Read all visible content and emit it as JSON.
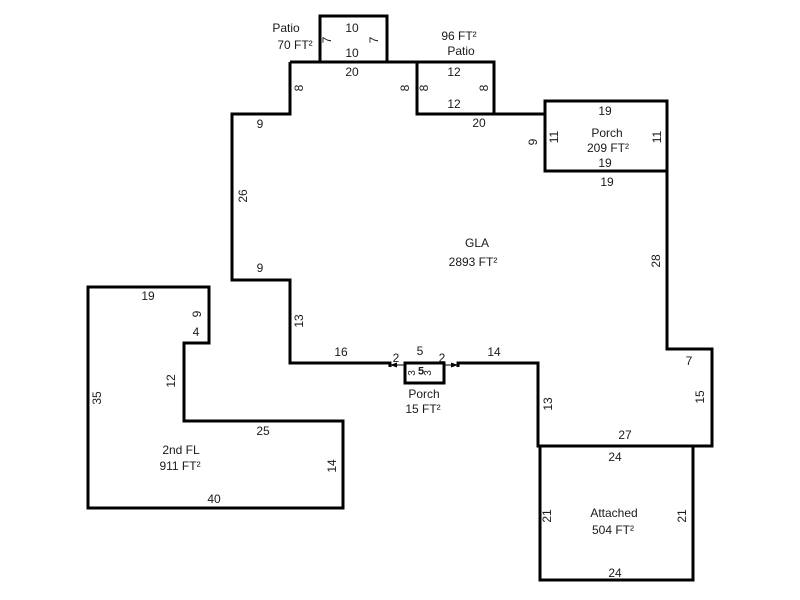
{
  "colors": {
    "line": "#000000",
    "text": "#1a1a1a",
    "background": "#ffffff"
  },
  "regions": [
    {
      "id": "patio-70",
      "labels": [
        {
          "name": "patio70-title",
          "text": "Patio",
          "x": 286,
          "y": 28,
          "rot": false
        },
        {
          "name": "patio70-area",
          "text": "70 FT²",
          "x": 295,
          "y": 45,
          "rot": false
        },
        {
          "name": "patio70-dim-top",
          "text": "10",
          "x": 352,
          "y": 28,
          "rot": false
        },
        {
          "name": "patio70-dim-left",
          "text": "7",
          "x": 327,
          "y": 40,
          "rot": true
        },
        {
          "name": "patio70-dim-right",
          "text": "7",
          "x": 374,
          "y": 40,
          "rot": true
        },
        {
          "name": "patio70-dim-bottom",
          "text": "10",
          "x": 352,
          "y": 53,
          "rot": false
        },
        {
          "name": "gla-dim-top-left-wall",
          "text": "20",
          "x": 352,
          "y": 72,
          "rot": false
        }
      ]
    },
    {
      "id": "patio-96",
      "labels": [
        {
          "name": "patio96-area",
          "text": "96 FT²",
          "x": 459,
          "y": 36,
          "rot": false
        },
        {
          "name": "patio96-title",
          "text": "Patio",
          "x": 461,
          "y": 51,
          "rot": false
        },
        {
          "name": "patio96-dim-top",
          "text": "12",
          "x": 454,
          "y": 72,
          "rot": false
        },
        {
          "name": "gla-dim-step-right",
          "text": "8",
          "x": 405,
          "y": 88,
          "rot": true
        },
        {
          "name": "patio96-dim-left",
          "text": "8",
          "x": 424,
          "y": 88,
          "rot": true
        },
        {
          "name": "patio96-dim-right",
          "text": "8",
          "x": 484,
          "y": 88,
          "rot": true
        },
        {
          "name": "patio96-dim-bottom",
          "text": "12",
          "x": 454,
          "y": 104,
          "rot": false
        },
        {
          "name": "gla-dim-top-right-wall",
          "text": "20",
          "x": 479,
          "y": 123,
          "rot": false
        }
      ]
    },
    {
      "id": "gla-left-side",
      "labels": [
        {
          "name": "gla-dim-left-upper",
          "text": "8",
          "x": 299,
          "y": 88,
          "rot": true
        },
        {
          "name": "gla-dim-step-left-top",
          "text": "9",
          "x": 260,
          "y": 124,
          "rot": false
        },
        {
          "name": "gla-dim-left-mid",
          "text": "26",
          "x": 243,
          "y": 196,
          "rot": true
        },
        {
          "name": "gla-dim-step-left-bottom",
          "text": "9",
          "x": 260,
          "y": 268,
          "rot": false
        },
        {
          "name": "gla-dim-left-lower",
          "text": "13",
          "x": 299,
          "y": 321,
          "rot": true
        }
      ]
    },
    {
      "id": "porch-209",
      "labels": [
        {
          "name": "porch209-dim-top",
          "text": "19",
          "x": 605,
          "y": 111,
          "rot": false
        },
        {
          "name": "gla-dim-porch-left",
          "text": "9",
          "x": 533,
          "y": 142,
          "rot": true
        },
        {
          "name": "porch209-dim-left",
          "text": "11",
          "x": 554,
          "y": 137,
          "rot": true
        },
        {
          "name": "porch209-title",
          "text": "Porch",
          "x": 607,
          "y": 133,
          "rot": false
        },
        {
          "name": "porch209-area",
          "text": "209 FT²",
          "x": 608,
          "y": 148,
          "rot": false
        },
        {
          "name": "porch209-dim-bottom",
          "text": "19",
          "x": 605,
          "y": 163,
          "rot": false
        },
        {
          "name": "porch209-dim-right",
          "text": "11",
          "x": 657,
          "y": 137,
          "rot": true
        },
        {
          "name": "gla-dim-top-porch-wall",
          "text": "19",
          "x": 607,
          "y": 182,
          "rot": false
        }
      ]
    },
    {
      "id": "gla-main",
      "labels": [
        {
          "name": "gla-title",
          "text": "GLA",
          "x": 477,
          "y": 243,
          "rot": false
        },
        {
          "name": "gla-area",
          "text": "2893 FT²",
          "x": 473,
          "y": 262,
          "rot": false
        },
        {
          "name": "gla-dim-right-upper",
          "text": "28",
          "x": 656,
          "y": 261,
          "rot": true
        },
        {
          "name": "gla-dim-right-jog",
          "text": "7",
          "x": 689,
          "y": 361,
          "rot": false
        },
        {
          "name": "gla-dim-right-lower",
          "text": "15",
          "x": 700,
          "y": 397,
          "rot": true
        },
        {
          "name": "gla-dim-bottom-right-wall",
          "text": "27",
          "x": 625,
          "y": 435,
          "rot": false
        },
        {
          "name": "gla-dim-right-inner",
          "text": "13",
          "x": 548,
          "y": 404,
          "rot": true
        }
      ]
    },
    {
      "id": "gla-bottom-wall",
      "labels": [
        {
          "name": "gla-dim-bottom-left-wall",
          "text": "16",
          "x": 341,
          "y": 352,
          "rot": false
        },
        {
          "name": "porch15-offset-left",
          "text": "2",
          "x": 396,
          "y": 358,
          "rot": false
        },
        {
          "name": "porch15-dim-top",
          "text": "5",
          "x": 420,
          "y": 351,
          "rot": false
        },
        {
          "name": "porch15-offset-right",
          "text": "2",
          "x": 442,
          "y": 358,
          "rot": false
        },
        {
          "name": "gla-dim-bottom-mid-wall",
          "text": "14",
          "x": 494,
          "y": 352,
          "rot": false
        }
      ]
    },
    {
      "id": "porch-15",
      "labels": [
        {
          "name": "porch15-dim-left",
          "text": "3",
          "x": 413,
          "y": 373,
          "rot": true,
          "size": 10
        },
        {
          "name": "porch15-dim-center",
          "text": "5",
          "x": 421,
          "y": 372,
          "rot": false,
          "size": 11,
          "bold": true
        },
        {
          "name": "porch15-dim-right",
          "text": "3",
          "x": 429,
          "y": 373,
          "rot": true,
          "size": 10
        },
        {
          "name": "porch15-title",
          "text": "Porch",
          "x": 424,
          "y": 394,
          "rot": false
        },
        {
          "name": "porch15-area",
          "text": "15 FT²",
          "x": 423,
          "y": 409,
          "rot": false
        }
      ]
    },
    {
      "id": "attached",
      "labels": [
        {
          "name": "attached-dim-top",
          "text": "24",
          "x": 615,
          "y": 457,
          "rot": false
        },
        {
          "name": "attached-dim-left",
          "text": "21",
          "x": 547,
          "y": 516,
          "rot": true
        },
        {
          "name": "attached-title",
          "text": "Attached",
          "x": 614,
          "y": 513,
          "rot": false
        },
        {
          "name": "attached-area",
          "text": "504 FT²",
          "x": 613,
          "y": 530,
          "rot": false
        },
        {
          "name": "attached-dim-right",
          "text": "21",
          "x": 682,
          "y": 516,
          "rot": true
        },
        {
          "name": "attached-dim-bottom",
          "text": "24",
          "x": 615,
          "y": 573,
          "rot": false
        }
      ]
    },
    {
      "id": "second-floor",
      "labels": [
        {
          "name": "secondfl-dim-top",
          "text": "19",
          "x": 148,
          "y": 296,
          "rot": false
        },
        {
          "name": "secondfl-dim-notch-right",
          "text": "9",
          "x": 197,
          "y": 314,
          "rot": true
        },
        {
          "name": "secondfl-dim-notch-top",
          "text": "4",
          "x": 196,
          "y": 332,
          "rot": false
        },
        {
          "name": "secondfl-dim-notch-left",
          "text": "12",
          "x": 171,
          "y": 381,
          "rot": true
        },
        {
          "name": "secondfl-dim-left",
          "text": "35",
          "x": 97,
          "y": 398,
          "rot": true
        },
        {
          "name": "secondfl-dim-mid",
          "text": "25",
          "x": 263,
          "y": 431,
          "rot": false
        },
        {
          "name": "secondfl-title",
          "text": "2nd FL",
          "x": 181,
          "y": 450,
          "rot": false
        },
        {
          "name": "secondfl-area",
          "text": "911 FT²",
          "x": 180,
          "y": 466,
          "rot": false
        },
        {
          "name": "secondfl-dim-right",
          "text": "14",
          "x": 332,
          "y": 466,
          "rot": true
        },
        {
          "name": "secondfl-dim-bottom",
          "text": "40",
          "x": 214,
          "y": 499,
          "rot": false
        }
      ]
    }
  ]
}
